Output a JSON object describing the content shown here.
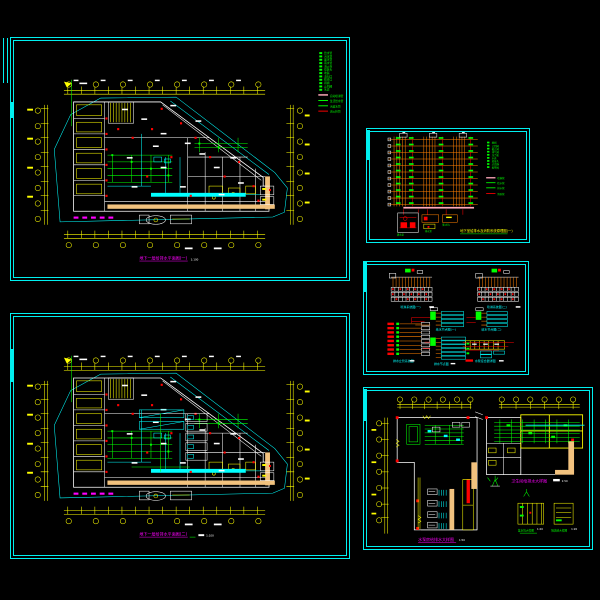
{
  "sheet": {
    "background": "#000000",
    "frame_color": "#00ffff"
  },
  "plan1": {
    "title": "地下一层给排水平面图(一)",
    "scale": "1:100",
    "legend": {
      "symbols": [
        "给水管",
        "污水管",
        "废水管",
        "雨水管",
        "消火栓",
        "喷淋头",
        "地漏",
        "清扫口",
        "检查口",
        "闸阀",
        "止回阀",
        "水表"
      ],
      "lines": [
        {
          "color": "#ffaabb",
          "label": "自动喷淋管"
        },
        {
          "color": "#00ff00",
          "label": "生活给水管"
        },
        {
          "color": "#00ff00",
          "label": "污废水管"
        },
        {
          "color": "#ff0000",
          "label": "消火栓管"
        }
      ]
    }
  },
  "plan2": {
    "title": "地下一层给排水平面图(二)",
    "scale": "1:100"
  },
  "riser": {
    "title": "地下室给排水及消防系统原理图(一)",
    "sub_labels": [
      "潜水泵",
      "集水坑",
      "排水泵"
    ],
    "legend": {
      "symbols": [
        "闸阀",
        "止回阀",
        "截止阀",
        "排气阀",
        "压力表",
        "水表",
        "软接头",
        "过滤器",
        "报警阀"
      ],
      "lines": [
        {
          "color": "#ffaabb",
          "label": "喷淋管"
        },
        {
          "color": "#00ff00",
          "label": "给水管"
        },
        {
          "color": "#00ff00",
          "label": "排水管"
        },
        {
          "color": "#ff0000",
          "label": "消防管"
        }
      ]
    }
  },
  "schematics": {
    "titles": [
      "喷淋系统图(一)",
      "喷淋系统图(二)",
      "排水立管系统图",
      "给水节点图(一)",
      "给水节点图(二)",
      "排水节点图",
      "水泵接合器详图"
    ]
  },
  "details": {
    "title_left": "水泵房给排水大样图",
    "scale_left": "1:50",
    "title_right": "卫生间给排水大样图",
    "scale_right": "1:50",
    "small_titles": [
      "集水坑大样图",
      "隔油池大样图"
    ],
    "small_scales": [
      "1:20",
      "1:20"
    ]
  }
}
